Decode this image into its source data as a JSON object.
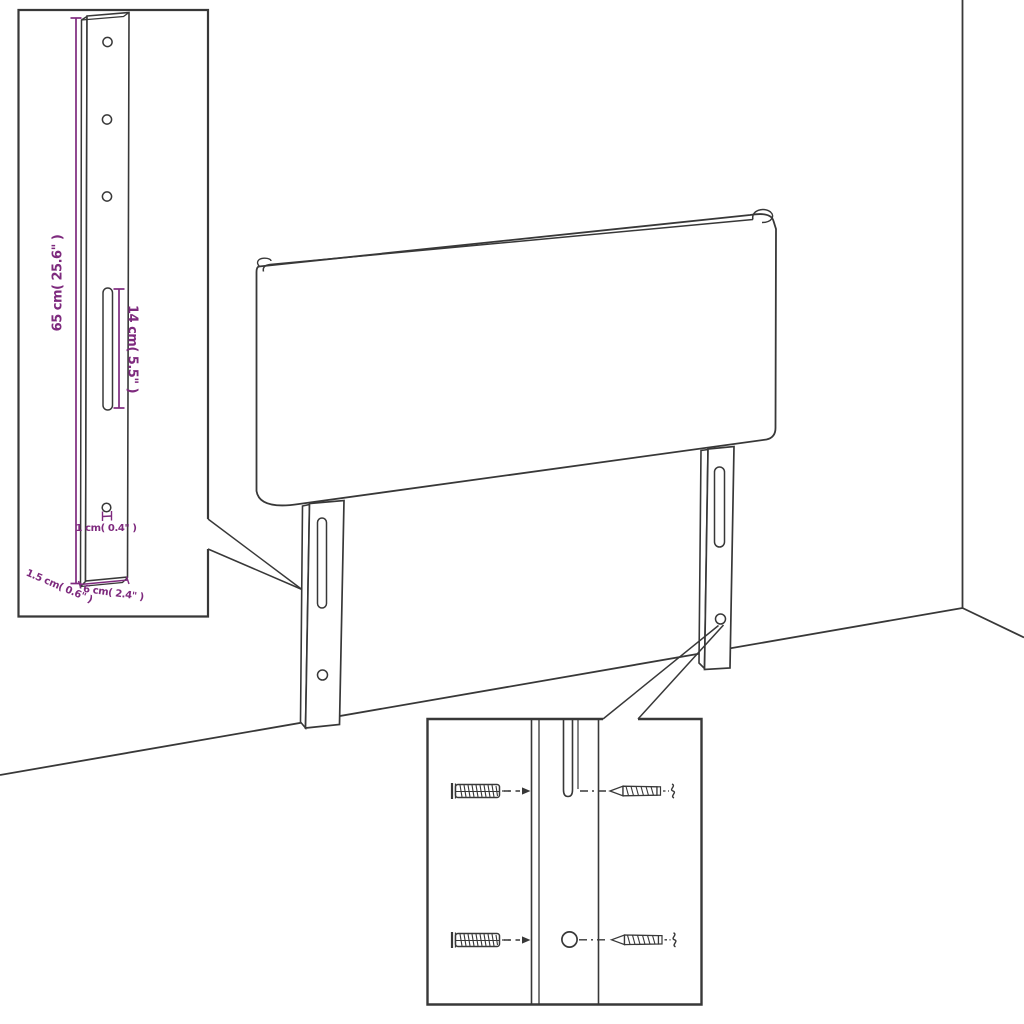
{
  "diagram": {
    "kind": "headboard wall-mount assembly dimension diagram",
    "colors": {
      "background": "#ffffff",
      "ink": "#383838",
      "accent": "#7e2a7e"
    },
    "bracket_detail": {
      "height_label": "65 cm( 25.6\" )",
      "slot_length_label": "14 cm( 5.5\" )",
      "hole_diameter_label": "1 cm( 0.4\" )",
      "thickness_label": "1.5 cm( 0.6\" )",
      "width_label": "6 cm( 2.4\" )"
    },
    "hardware_detail": {
      "left_icons": "wall-plug-icon",
      "right_icons": "screw-icon"
    }
  }
}
